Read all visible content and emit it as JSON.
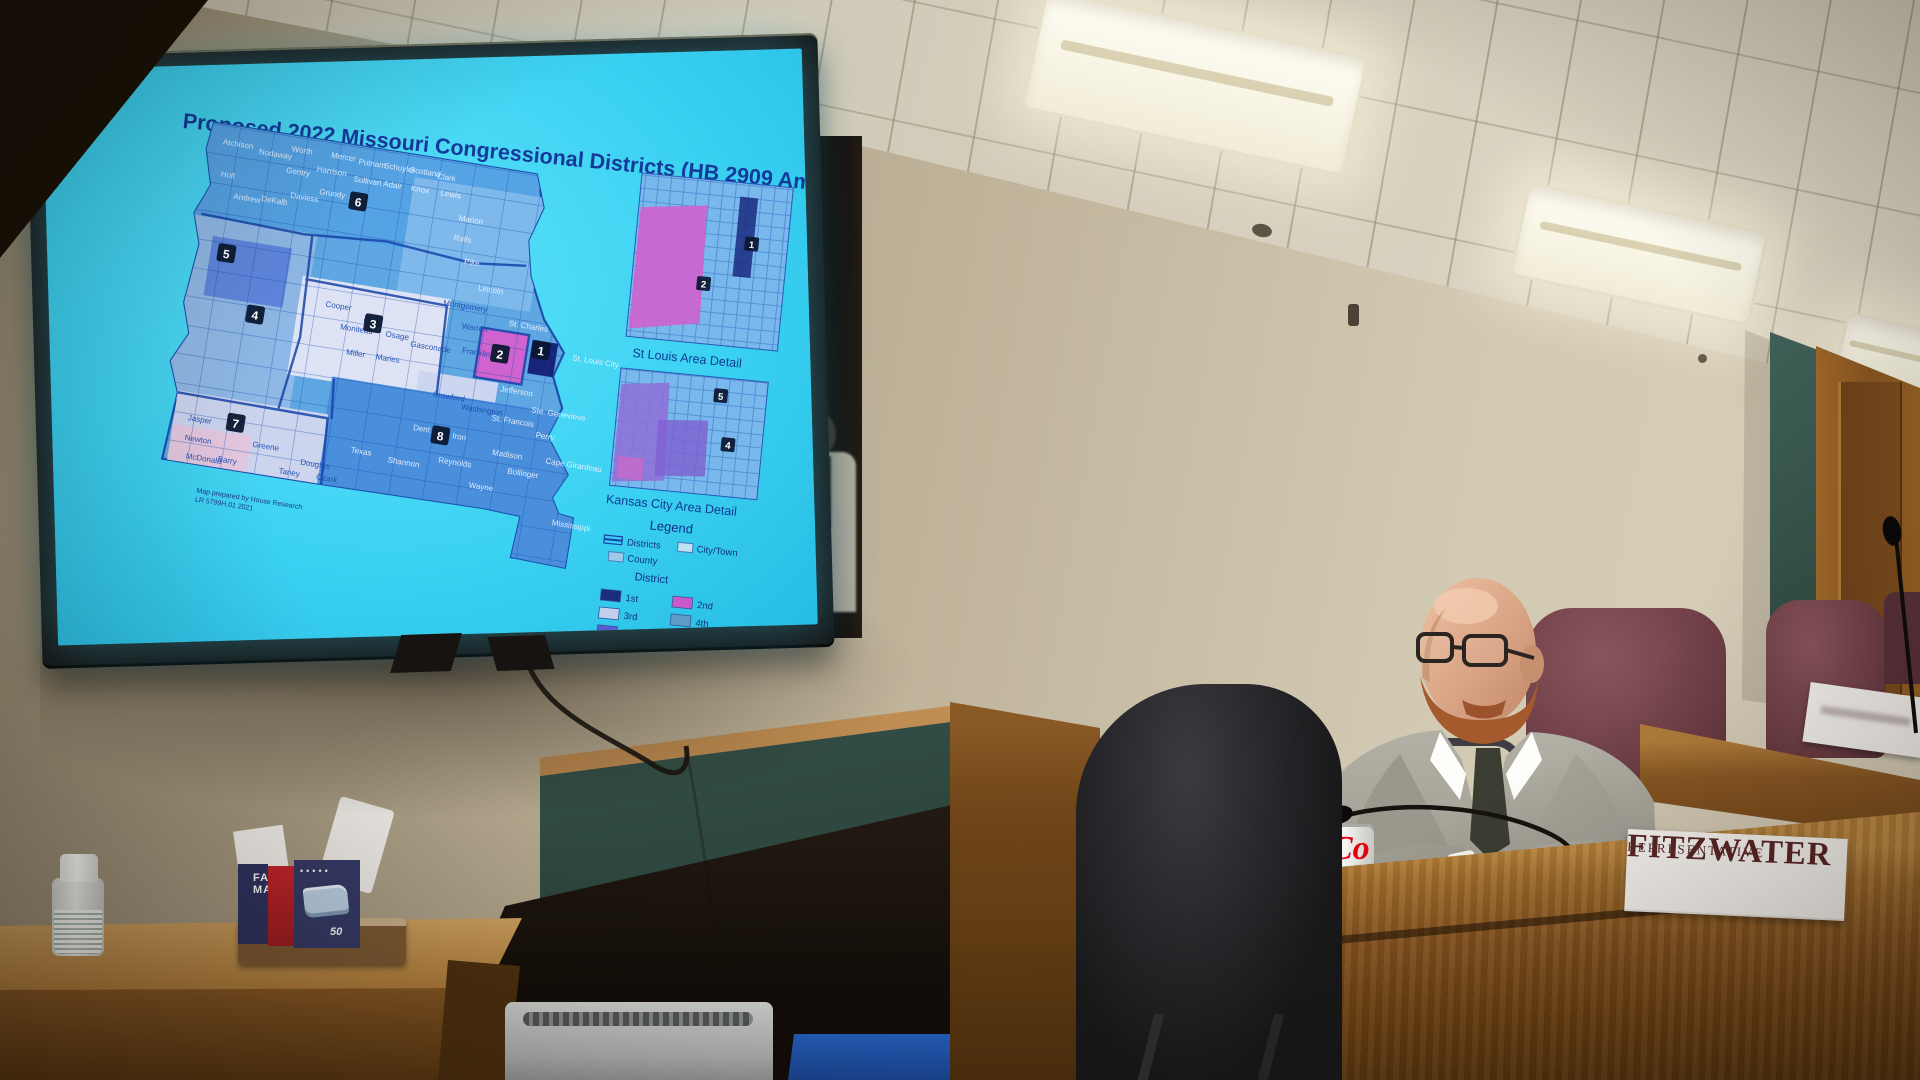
{
  "screen": {
    "title": "Proposed 2022 Missouri Congressional Districts (HB 2909 Amendment _)",
    "map": {
      "footnote_line1": "Map prepared by House Research",
      "footnote_line2": "LR 5799H.01 2021",
      "district_badges": [
        {
          "n": "6",
          "x": 298,
          "y": 86
        },
        {
          "n": "5",
          "x": 176,
          "y": 158
        },
        {
          "n": "4",
          "x": 214,
          "y": 214
        },
        {
          "n": "3",
          "x": 332,
          "y": 204
        },
        {
          "n": "2",
          "x": 462,
          "y": 214
        },
        {
          "n": "1",
          "x": 502,
          "y": 204
        },
        {
          "n": "8",
          "x": 416,
          "y": 304
        },
        {
          "n": "7",
          "x": 212,
          "y": 324
        }
      ],
      "counties": [
        {
          "name": "Atchison",
          "x": 155,
          "y": 48,
          "lt": 1
        },
        {
          "name": "Nodaway",
          "x": 192,
          "y": 52,
          "lt": 1
        },
        {
          "name": "Worth",
          "x": 224,
          "y": 44,
          "lt": 1
        },
        {
          "name": "Gentry",
          "x": 222,
          "y": 66,
          "lt": 1
        },
        {
          "name": "Harrison",
          "x": 252,
          "y": 60,
          "lt": 1
        },
        {
          "name": "Mercer",
          "x": 264,
          "y": 44,
          "lt": 1
        },
        {
          "name": "Putnam",
          "x": 292,
          "y": 46,
          "lt": 1
        },
        {
          "name": "Schuyler",
          "x": 318,
          "y": 46,
          "lt": 1
        },
        {
          "name": "Scotland",
          "x": 344,
          "y": 46,
          "lt": 1
        },
        {
          "name": "Clark",
          "x": 372,
          "y": 48,
          "lt": 1
        },
        {
          "name": "Holt",
          "x": 158,
          "y": 80,
          "lt": 1
        },
        {
          "name": "Andrew",
          "x": 174,
          "y": 100,
          "lt": 1
        },
        {
          "name": "DeKalb",
          "x": 202,
          "y": 98,
          "lt": 1
        },
        {
          "name": "Daviess",
          "x": 230,
          "y": 90,
          "lt": 1
        },
        {
          "name": "Grundy",
          "x": 258,
          "y": 82,
          "lt": 1
        },
        {
          "name": "Sullivan",
          "x": 290,
          "y": 64,
          "lt": 1
        },
        {
          "name": "Adair",
          "x": 320,
          "y": 64,
          "lt": 1
        },
        {
          "name": "Knox",
          "x": 348,
          "y": 64,
          "lt": 1
        },
        {
          "name": "Lewis",
          "x": 378,
          "y": 64,
          "lt": 1
        },
        {
          "name": "Marion",
          "x": 400,
          "y": 86,
          "lt": 1
        },
        {
          "name": "Ralls",
          "x": 398,
          "y": 106,
          "lt": 1
        },
        {
          "name": "Pike",
          "x": 412,
          "y": 128,
          "lt": 1
        },
        {
          "name": "Lincoln",
          "x": 430,
          "y": 152,
          "lt": 1
        },
        {
          "name": "Montgomery",
          "x": 398,
          "y": 172,
          "lt": 0
        },
        {
          "name": "Warren",
          "x": 420,
          "y": 192,
          "lt": 0
        },
        {
          "name": "St. Charles",
          "x": 466,
          "y": 182,
          "lt": 1
        },
        {
          "name": "Cooper",
          "x": 282,
          "y": 192,
          "lt": 0
        },
        {
          "name": "Moniteau",
          "x": 300,
          "y": 212,
          "lt": 0
        },
        {
          "name": "Cole",
          "x": 322,
          "y": 202,
          "lt": 0
        },
        {
          "name": "Osage",
          "x": 346,
          "y": 212,
          "lt": 0
        },
        {
          "name": "Gasconade",
          "x": 372,
          "y": 218,
          "lt": 0
        },
        {
          "name": "Maries",
          "x": 340,
          "y": 236,
          "lt": 0
        },
        {
          "name": "Miller",
          "x": 310,
          "y": 236,
          "lt": 0
        },
        {
          "name": "Franklin",
          "x": 424,
          "y": 216,
          "lt": 0
        },
        {
          "name": "Crawford",
          "x": 402,
          "y": 264,
          "lt": 0
        },
        {
          "name": "Washington",
          "x": 432,
          "y": 272,
          "lt": 0
        },
        {
          "name": "Jefferson",
          "x": 468,
          "y": 248,
          "lt": 1
        },
        {
          "name": "St. Louis City",
          "x": 534,
          "y": 206,
          "lt": 1
        },
        {
          "name": "Ste. Genevieve",
          "x": 502,
          "y": 264,
          "lt": 1
        },
        {
          "name": "St. Francois",
          "x": 464,
          "y": 278,
          "lt": 1
        },
        {
          "name": "Perry",
          "x": 510,
          "y": 288,
          "lt": 1
        },
        {
          "name": "Madison",
          "x": 470,
          "y": 312,
          "lt": 1
        },
        {
          "name": "Iron",
          "x": 428,
          "y": 302,
          "lt": 1
        },
        {
          "name": "Dent",
          "x": 388,
          "y": 300,
          "lt": 1
        },
        {
          "name": "Reynolds",
          "x": 418,
          "y": 328,
          "lt": 1
        },
        {
          "name": "Bollinger",
          "x": 488,
          "y": 328,
          "lt": 1
        },
        {
          "name": "Cape Girardeau",
          "x": 524,
          "y": 312,
          "lt": 1
        },
        {
          "name": "Wayne",
          "x": 452,
          "y": 348,
          "lt": 1
        },
        {
          "name": "Mississippi",
          "x": 540,
          "y": 372,
          "lt": 1
        },
        {
          "name": "Jasper",
          "x": 164,
          "y": 326,
          "lt": 0
        },
        {
          "name": "Newton",
          "x": 164,
          "y": 346,
          "lt": 0
        },
        {
          "name": "McDonald",
          "x": 168,
          "y": 364,
          "lt": 0
        },
        {
          "name": "Barry",
          "x": 200,
          "y": 362,
          "lt": 0
        },
        {
          "name": "Greene",
          "x": 232,
          "y": 342,
          "lt": 0
        },
        {
          "name": "Taney",
          "x": 262,
          "y": 364,
          "lt": 0
        },
        {
          "name": "Ozark",
          "x": 300,
          "y": 364,
          "lt": 0
        },
        {
          "name": "Douglas",
          "x": 282,
          "y": 352,
          "lt": 0
        },
        {
          "name": "Texas",
          "x": 330,
          "y": 332,
          "lt": 1
        },
        {
          "name": "Shannon",
          "x": 368,
          "y": 336,
          "lt": 1
        }
      ]
    },
    "insets": [
      {
        "label": "St Louis Area Detail",
        "badges": [
          {
            "n": "1",
            "x": 716,
            "y": 118
          },
          {
            "n": "2",
            "x": 672,
            "y": 162
          }
        ]
      },
      {
        "label": "Kansas City Area Detail",
        "badges": [
          {
            "n": "5",
            "x": 700,
            "y": 272
          },
          {
            "n": "4",
            "x": 712,
            "y": 320
          }
        ]
      }
    ],
    "legend": {
      "title": "Legend",
      "districts_label": "Districts",
      "citytown_label": "City/Town",
      "county_label": "County",
      "district_header": "District",
      "entries": [
        {
          "label": "1st",
          "color": "#1b2d7d"
        },
        {
          "label": "2nd",
          "color": "#c958c9"
        },
        {
          "label": "3rd",
          "color": "#c2cfec"
        },
        {
          "label": "4th",
          "color": "#5e9cc6"
        },
        {
          "label": "5th",
          "color": "#5c5cd2"
        },
        {
          "label": "6th",
          "color": "#9fc6ea"
        },
        {
          "label": "7th",
          "color": "#7b90ca"
        },
        {
          "label": "8th",
          "color": "#7568d2"
        }
      ]
    }
  },
  "nameplate": {
    "line1": "Representative",
    "line2": "Fitzwater"
  },
  "desk_items": {
    "can_brand": "Co"
  },
  "mask_box": {
    "line1": "FACE",
    "line2": "MASK",
    "count": "50"
  },
  "colors": {
    "screen_cyan": "#3fd7f7",
    "accent_blue": "#15399b",
    "magenta_district": "#cf63cf"
  }
}
